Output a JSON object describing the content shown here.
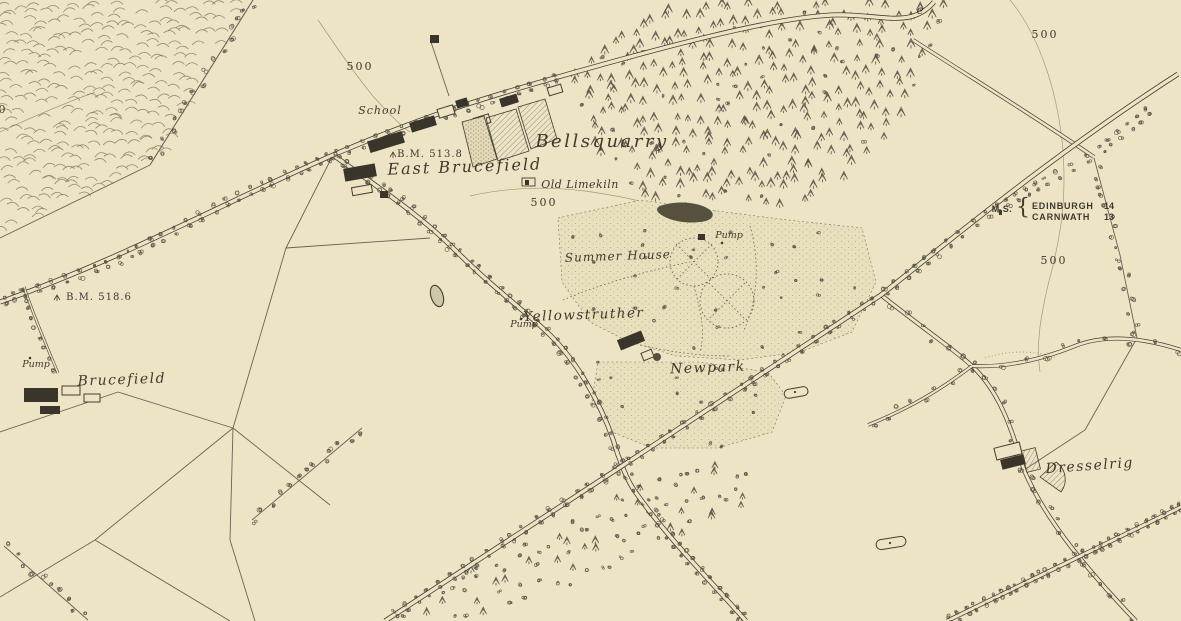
{
  "map": {
    "colors": {
      "paper": "#ede4c6",
      "ink": "#433d2e",
      "text_ink": "#3e392b",
      "field_line": "#6a6252",
      "tree": "#555043",
      "contour": "#998f72",
      "hachure": "#7d7459",
      "building": "#3a352a",
      "pond_fill": "#cfc8a8",
      "pond_dark": "#56513f",
      "parkland": "#e8dfbd"
    },
    "contour_value": "500",
    "benchmarks": [
      "B.M. 513.8",
      "B.M. 518.6"
    ],
    "milestone": {
      "abbr": "M.S.",
      "destinations": [
        {
          "place": "EDINBURGH",
          "miles": "14"
        },
        {
          "place": "CARNWATH",
          "miles": "13"
        }
      ]
    },
    "labels": [
      {
        "id": "school",
        "text": "School",
        "x": 380,
        "y": 114,
        "size": 11,
        "it": 1,
        "sp": 1
      },
      {
        "id": "bm-513-8",
        "text": "B.M. 513.8",
        "x": 430,
        "y": 157,
        "size": 10,
        "sp": 1
      },
      {
        "id": "east-brucefield",
        "text": "East Brucefield",
        "x": 465,
        "y": 172,
        "size": 16,
        "it": 1,
        "sp": 2,
        "rot": -2
      },
      {
        "id": "bellsquarry",
        "text": "Bellsquarry",
        "x": 602,
        "y": 147,
        "size": 18,
        "it": 1,
        "sp": 2.5
      },
      {
        "id": "old-limekiln",
        "text": "Old Limekiln",
        "x": 580,
        "y": 188,
        "size": 11,
        "it": 1,
        "sp": 0.5
      },
      {
        "id": "contour-500-nw",
        "text": "500",
        "x": 360,
        "y": 70,
        "size": 11,
        "sp": 2
      },
      {
        "id": "contour-500-center",
        "text": "500",
        "x": 544,
        "y": 206,
        "size": 11,
        "sp": 2
      },
      {
        "id": "contour-500-ne",
        "text": "500",
        "x": 1045,
        "y": 38,
        "size": 11,
        "sp": 2
      },
      {
        "id": "contour-500-e",
        "text": "500",
        "x": 1054,
        "y": 264,
        "size": 11,
        "sp": 2
      },
      {
        "id": "contour-500-w",
        "text": "500",
        "x": -6,
        "y": 113,
        "size": 11,
        "sp": 2
      },
      {
        "id": "summer-house",
        "text": "Summer House",
        "x": 618,
        "y": 260,
        "size": 12,
        "it": 1,
        "sp": 1,
        "rot": -2
      },
      {
        "id": "pump-garden",
        "text": "Pump",
        "x": 729,
        "y": 238,
        "size": 9.5,
        "it": 1
      },
      {
        "id": "pump-yellowstruther",
        "text": "Pump",
        "x": 524,
        "y": 327,
        "size": 9.5,
        "it": 1
      },
      {
        "id": "pump-brucefield",
        "text": "Pump",
        "x": 36,
        "y": 367,
        "size": 9.5,
        "it": 1
      },
      {
        "id": "yellowstruther",
        "text": "Yellowstruther",
        "x": 584,
        "y": 319,
        "size": 13.5,
        "it": 1,
        "sp": 1.5,
        "rot": -2
      },
      {
        "id": "newpark",
        "text": "Newpark",
        "x": 708,
        "y": 372,
        "size": 14,
        "it": 1,
        "sp": 1.5,
        "rot": -2
      },
      {
        "id": "brucefield",
        "text": "Brucefield",
        "x": 122,
        "y": 384,
        "size": 14,
        "it": 1,
        "sp": 1.5,
        "rot": -2
      },
      {
        "id": "bm-518-6",
        "text": "B.M. 518.6",
        "x": 99,
        "y": 300,
        "size": 10,
        "sp": 1
      },
      {
        "id": "dresselrig",
        "text": "Dresselrig",
        "x": 1090,
        "y": 470,
        "size": 14,
        "it": 1,
        "sp": 1.5,
        "rot": -4
      },
      {
        "id": "milestone-abbr",
        "text": "M.S.",
        "x": 1002,
        "y": 212,
        "size": 9,
        "f": "sans",
        "w": "bold",
        "sp": 0.5
      },
      {
        "id": "milestone-brace",
        "text": "{",
        "x": 1023,
        "y": 214,
        "size": 22
      },
      {
        "id": "milestone-dest-edinburgh",
        "text": "EDINBURGH",
        "x": 1032,
        "y": 209,
        "size": 9,
        "f": "sans",
        "w": "bold",
        "anchor": "start",
        "sp": 0.8
      },
      {
        "id": "milestone-miles-edinburgh",
        "text": "14",
        "x": 1104,
        "y": 209,
        "size": 9,
        "f": "sans",
        "w": "bold",
        "anchor": "start"
      },
      {
        "id": "milestone-dest-carnwath",
        "text": "CARNWATH",
        "x": 1032,
        "y": 220,
        "size": 9,
        "f": "sans",
        "w": "bold",
        "anchor": "start",
        "sp": 0.8
      },
      {
        "id": "milestone-miles-carnwath",
        "text": "13",
        "x": 1104,
        "y": 220,
        "size": 9,
        "f": "sans",
        "w": "bold",
        "anchor": "start"
      },
      {
        "id": "stray-letter",
        "text": "e",
        "x": 920,
        "y": 14,
        "size": 12,
        "it": 1
      }
    ]
  }
}
